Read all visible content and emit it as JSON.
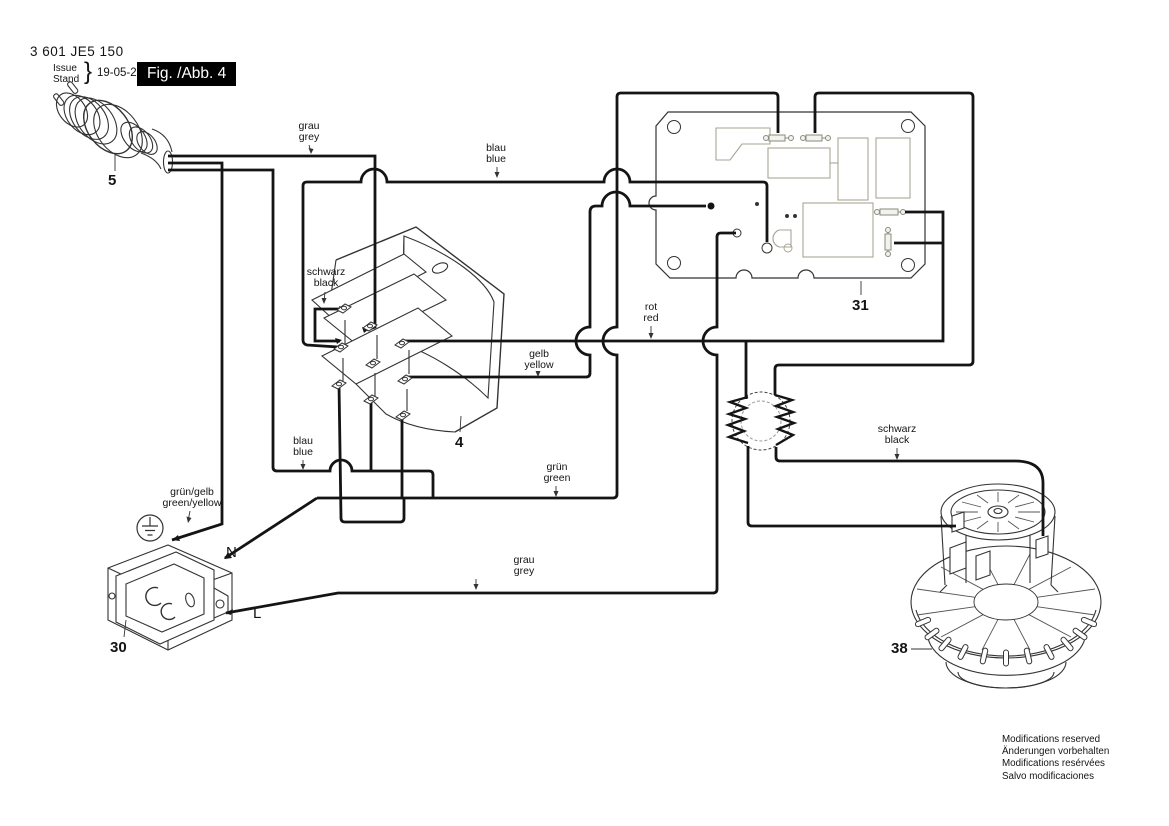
{
  "title_block": {
    "part_number": "3 601 JE5 150",
    "issue_label": "Issue",
    "stand_label": "Stand",
    "brace": "}",
    "date": "19-05-29",
    "figure_label": "Fig. /Abb. 4"
  },
  "callouts": {
    "plug": "5",
    "switch": "4",
    "circuit_board": "31",
    "socket": "30",
    "motor": "38"
  },
  "wire_labels": {
    "grau_top": {
      "l1": "grau",
      "l2": "grey"
    },
    "blau_top": {
      "l1": "blau",
      "l2": "blue"
    },
    "schwarz_sw": {
      "l1": "schwarz",
      "l2": "black"
    },
    "gelb": {
      "l1": "gelb",
      "l2": "yellow"
    },
    "rot": {
      "l1": "rot",
      "l2": "red"
    },
    "blau_bottom": {
      "l1": "blau",
      "l2": "blue"
    },
    "gruen": {
      "l1": "grün",
      "l2": "green"
    },
    "gruen_gelb": {
      "l1": "grün/gelb",
      "l2": "green/yellow"
    },
    "grau_bottom": {
      "l1": "grau",
      "l2": "grey"
    },
    "schwarz_mot": {
      "l1": "schwarz",
      "l2": "black"
    }
  },
  "terminals": {
    "neutral": "N",
    "line": "L"
  },
  "footer": {
    "line1": "Modifications reserved",
    "line2": "Änderungen vorbehalten",
    "line3": "Modifications resérvées",
    "line4": "Salvo modificaciones"
  }
}
